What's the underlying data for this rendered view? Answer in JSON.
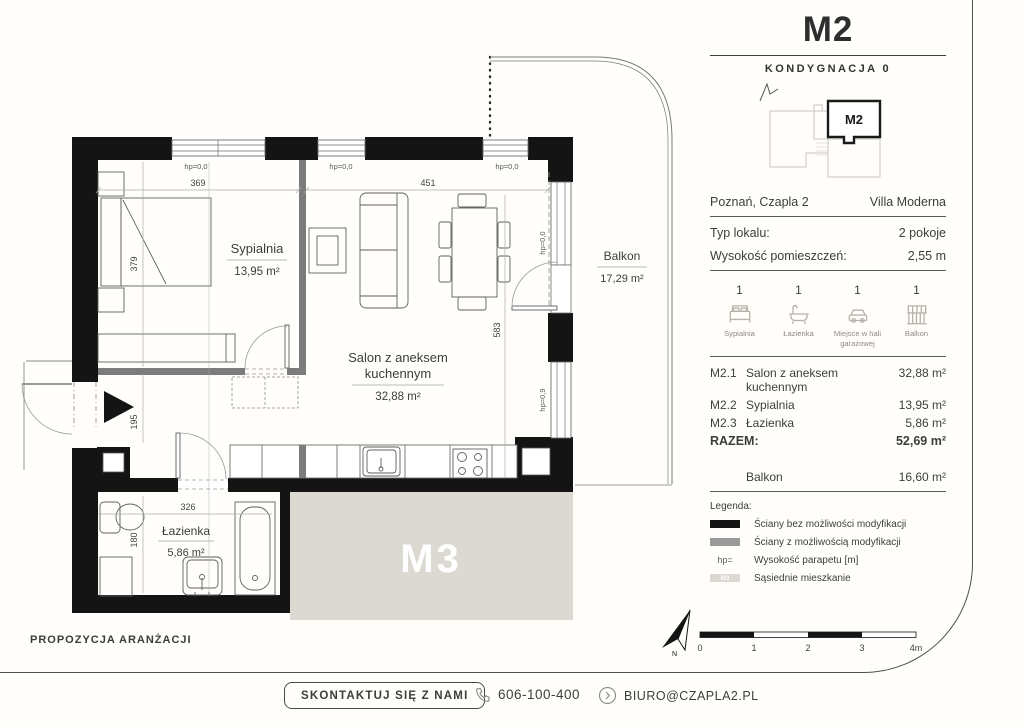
{
  "header": {
    "unit": "M2",
    "floor_label": "KONDYGNACJA 0",
    "locator_unit": "M2"
  },
  "info": {
    "location": "Poznań, Czapla 2",
    "project": "Villa Moderna",
    "type_label": "Typ lokalu:",
    "type_value": "2 pokoje",
    "height_label": "Wysokość pomieszczeń:",
    "height_value": "2,55 m"
  },
  "amenities": [
    {
      "count": "1",
      "label": "Sypialnia"
    },
    {
      "count": "1",
      "label": "Łazienka"
    },
    {
      "count": "1",
      "label": "Miejsce w hali garażowej"
    },
    {
      "count": "1",
      "label": "Balkon"
    }
  ],
  "rooms": {
    "items": [
      {
        "code": "M2.1",
        "name": "Salon z aneksem kuchennym",
        "area": "32,88 m²"
      },
      {
        "code": "M2.2",
        "name": "Sypialnia",
        "area": "13,95 m²"
      },
      {
        "code": "M2.3",
        "name": "Łazienka",
        "area": "5,86 m²"
      }
    ],
    "total_label": "RAZEM:",
    "total_area": "52,69 m²",
    "balcony_name": "Balkon",
    "balcony_area": "16,60 m²"
  },
  "legend": {
    "title": "Legenda:",
    "items": [
      {
        "symbol": "",
        "label": "Ściany bez możliwości modyfikacji"
      },
      {
        "symbol": "",
        "label": "Ściany z możliwością modyfikacji"
      },
      {
        "symbol": "hp=",
        "label": "Wysokość parapetu [m]"
      },
      {
        "symbol": "M3",
        "label": "Sąsiednie mieszkanie"
      }
    ]
  },
  "plan": {
    "labels": {
      "bedroom_name": "Sypialnia",
      "bedroom_area": "13,95 m²",
      "living_name1": "Salon z aneksem",
      "living_name2": "kuchennym",
      "living_area": "32,88 m²",
      "bath_name": "Łazienka",
      "bath_area": "5,86 m²",
      "balcony_name": "Balkon",
      "balcony_area": "17,29 m²",
      "neighbor": "M3"
    },
    "dims": {
      "d369": "369",
      "d451": "451",
      "d379": "379",
      "d195": "195",
      "d326": "326",
      "d180": "180",
      "d583": "583"
    },
    "hp": {
      "t1": "hp=0,0",
      "t2": "hp=0,0",
      "t3": "hp=0,0",
      "r1": "hp=0,0",
      "r2": "hp=0,9"
    }
  },
  "scalebar": {
    "t0": "0",
    "t1": "1",
    "t2": "2",
    "t3": "3",
    "t4": "4m",
    "north": "N"
  },
  "footer": {
    "proposal": "PROPOZYCJA ARANŻACJI",
    "contact_button": "SKONTAKTUJ SIĘ Z NAMI",
    "phone": "606-100-400",
    "email": "BIURO@CZAPLA2.PL"
  },
  "colors": {
    "wall": "#141414",
    "wall_modifiable": "#7c7c7c",
    "neighbor_fill": "#dcd8d2",
    "text": "#3d3d3d"
  }
}
